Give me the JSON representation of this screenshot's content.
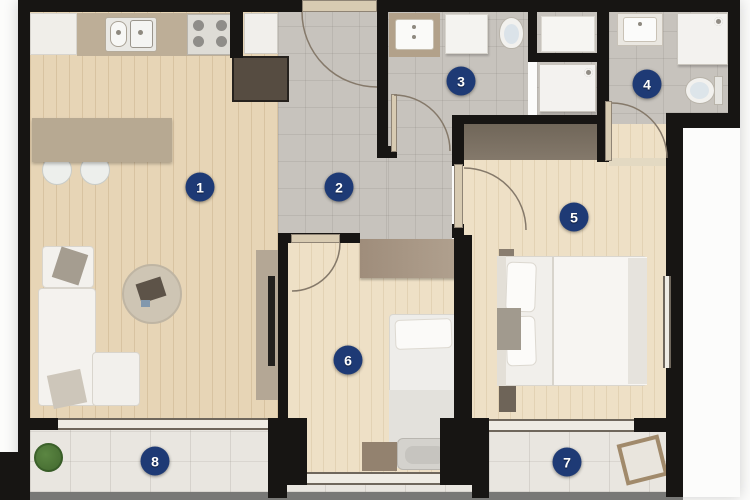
{
  "badges": [
    {
      "number": "1",
      "room": "living-room-kitchen",
      "x": 200,
      "y": 187
    },
    {
      "number": "2",
      "room": "hallway",
      "x": 339,
      "y": 187
    },
    {
      "number": "3",
      "room": "bathroom",
      "x": 461,
      "y": 81
    },
    {
      "number": "4",
      "room": "ensuite-bathroom",
      "x": 647,
      "y": 84
    },
    {
      "number": "5",
      "room": "bedroom",
      "x": 574,
      "y": 217
    },
    {
      "number": "6",
      "room": "bedroom-2",
      "x": 348,
      "y": 360
    },
    {
      "number": "7",
      "room": "balcony",
      "x": 567,
      "y": 462
    },
    {
      "number": "8",
      "room": "balcony-2",
      "x": 155,
      "y": 461
    }
  ],
  "icons": [
    {
      "name": "shower-head-icon",
      "count": 2
    },
    {
      "name": "plant-icon",
      "count": 1
    }
  ],
  "colors": {
    "badge": "#1e3a75",
    "wall": "#171513",
    "wood_living": "#e7d5b6",
    "wood_bedroom": "#eee0c6",
    "tile": "#c7c3bd",
    "balcony": "#e9e6e0",
    "counter": "#bdae97",
    "island": "#b7a992",
    "wardrobe_dark": "#7b7063",
    "cabinet_dark": "#564c41",
    "desk": "#a18f7e",
    "plant": "#4e7a3a",
    "ground_strip": "#787876",
    "door_leaf": "#d8cbb2"
  }
}
